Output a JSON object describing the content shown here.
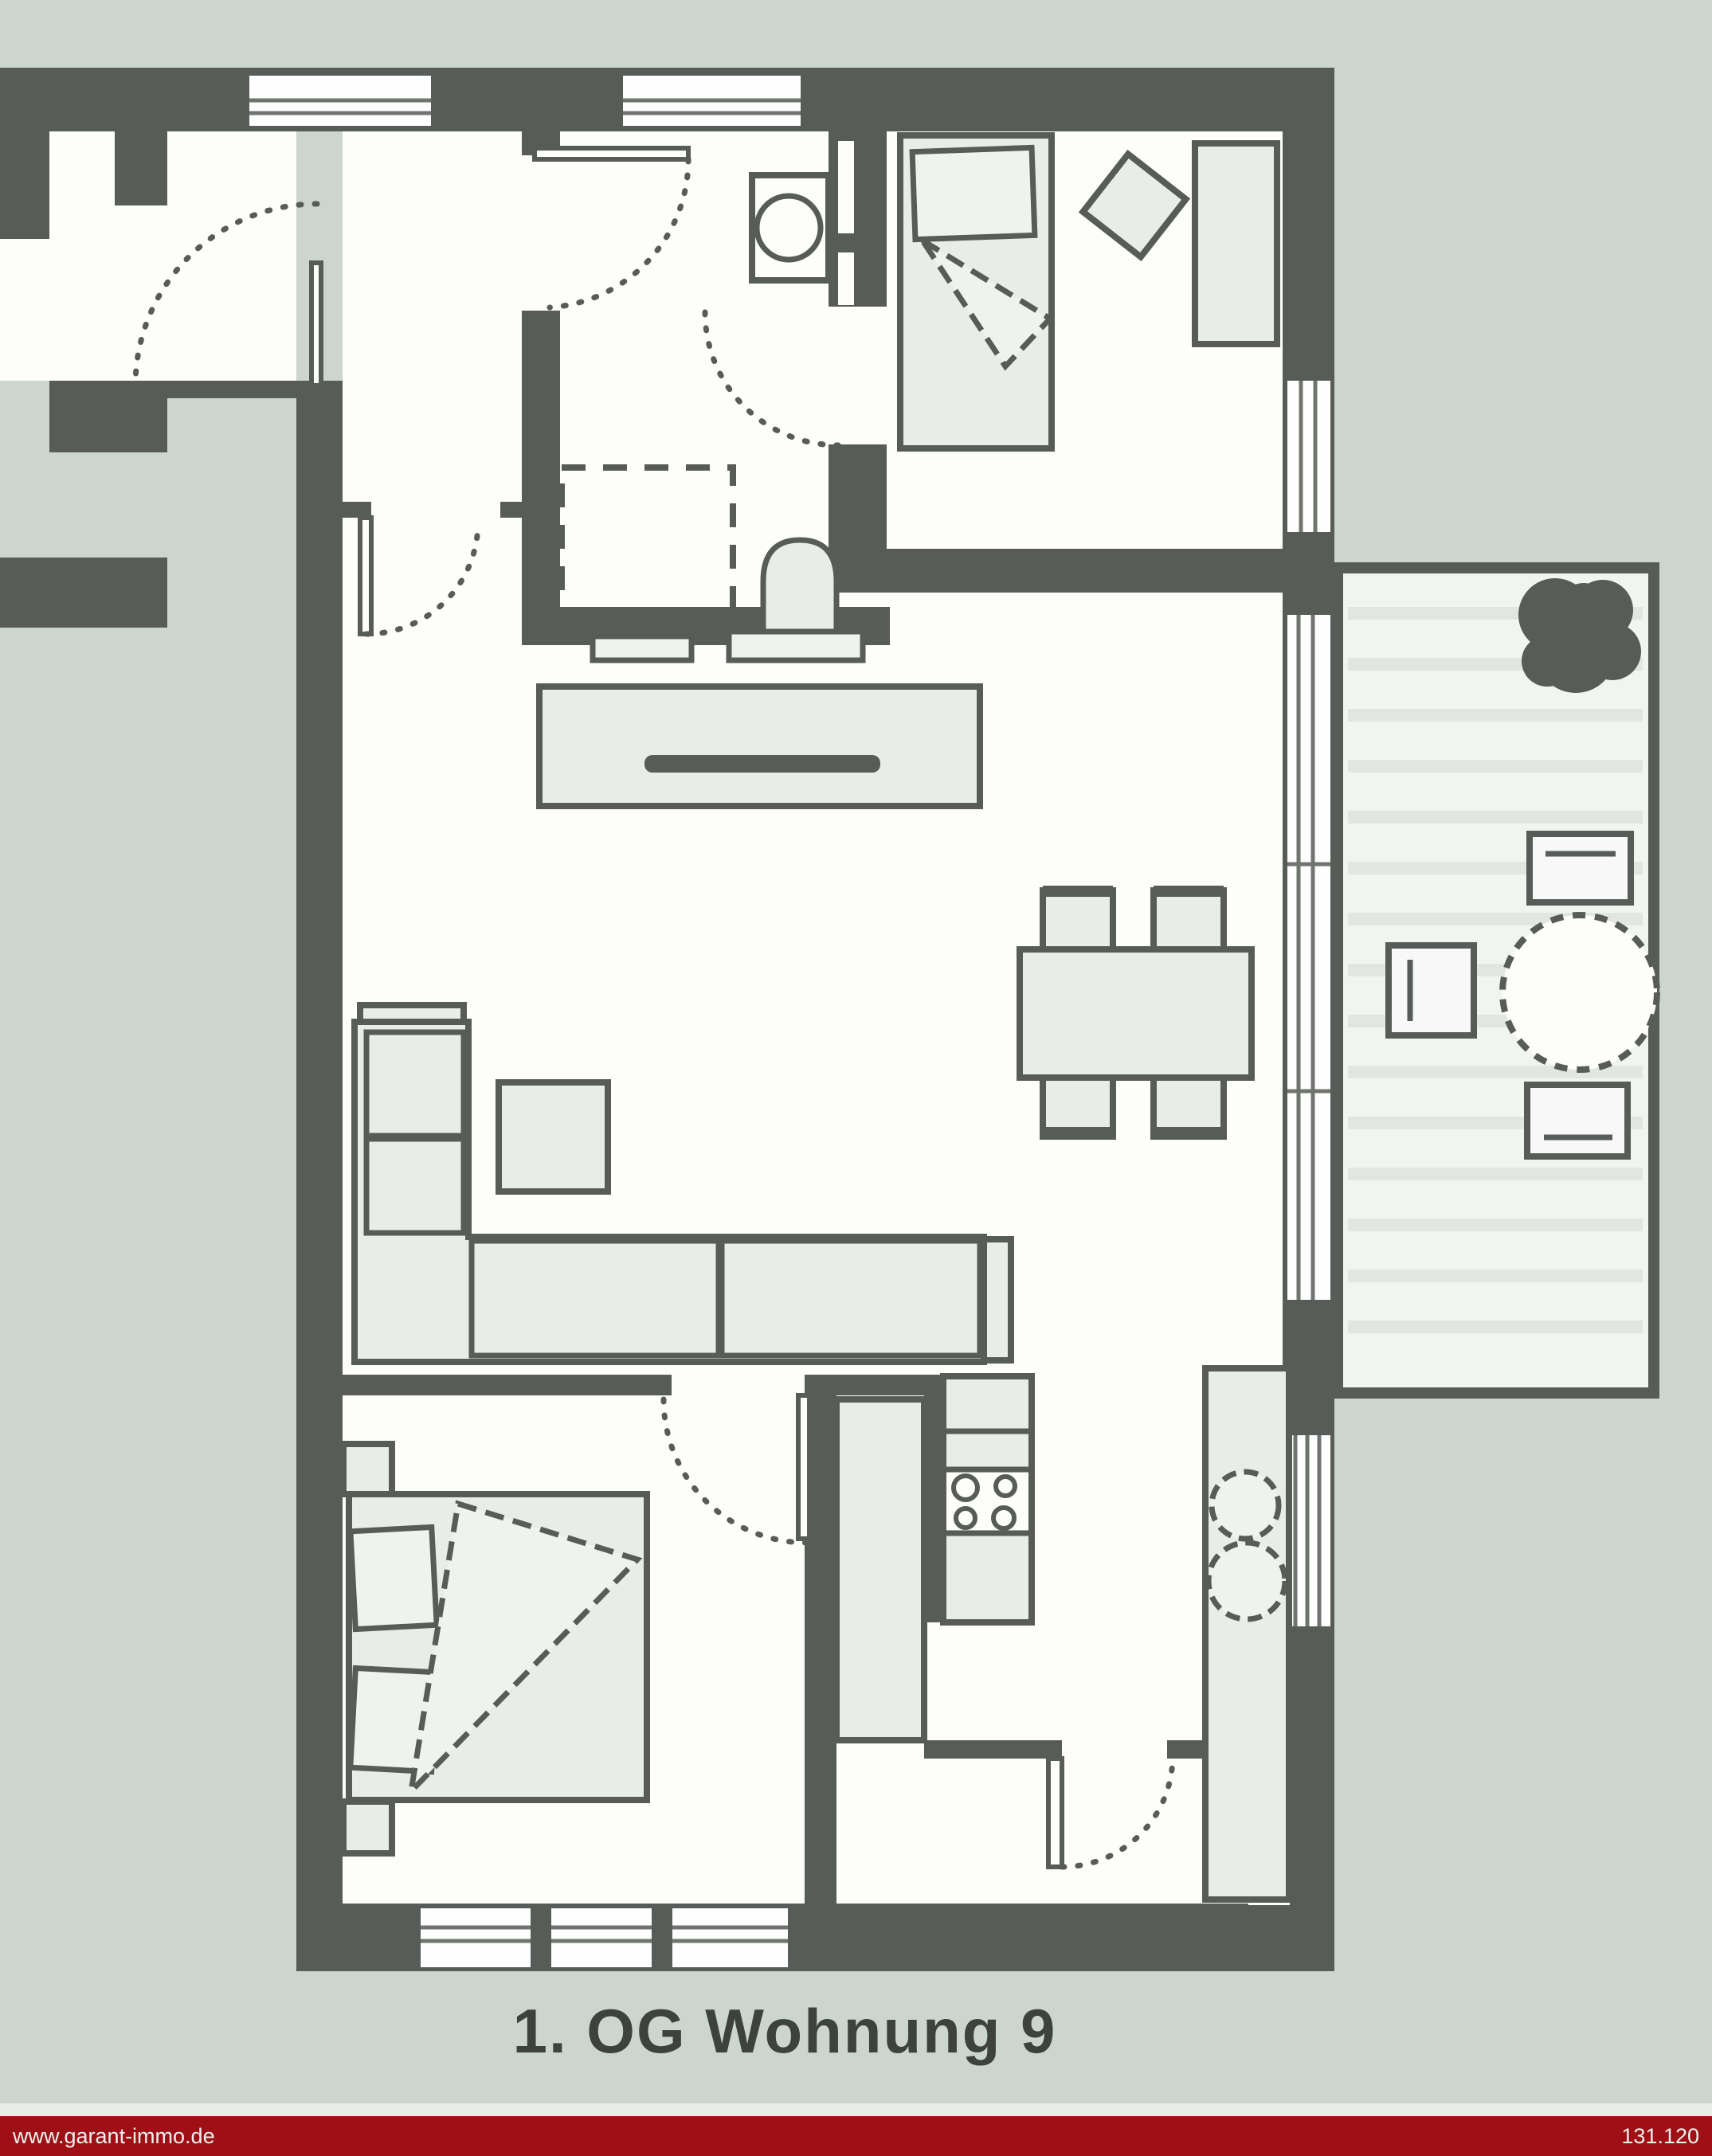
{
  "plan": {
    "caption": "1. OG Wohnung 9"
  },
  "footer": {
    "left": "www.garant-immo.de",
    "right": "131.120"
  },
  "colors": {
    "bg": "#ccd6cf",
    "wall": "#575c58",
    "room": "#fdfdfc",
    "furn": "#e9ece9",
    "furnLight": "#f0f2f0",
    "deck": "#f2f4f2",
    "deckline": "#e2e6e3",
    "winline": "#70746f",
    "footerBg": "#9e1015",
    "footerText": "#f3f1ef",
    "caption": "#3e423f"
  }
}
